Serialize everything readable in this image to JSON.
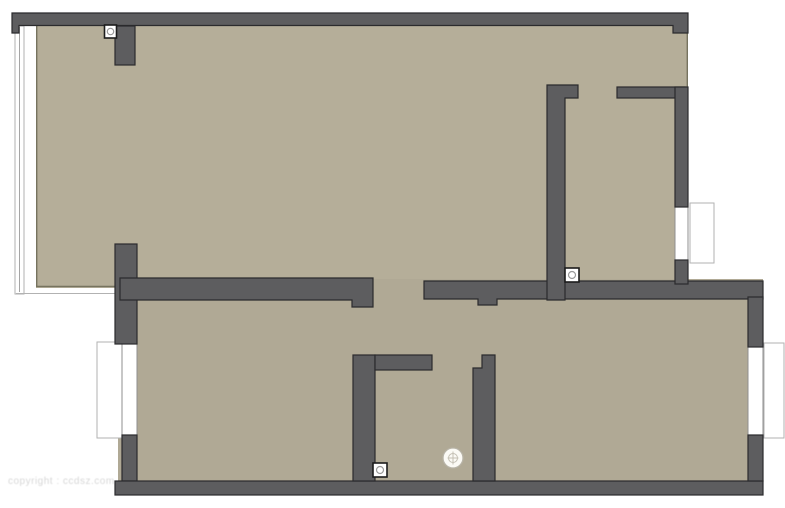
{
  "title": "Apartment Floor Plan",
  "watermark": "copyright : ccdsz.com",
  "colors": {
    "background": "#ffffff",
    "wall": "#5d5d5f",
    "wall_outline": "#2b2b2d",
    "floor": "#b5ae99",
    "floor_lower": "#b0a995",
    "floor_edge": "#76735f",
    "window_fill": "#ffffff",
    "window_frame": "#8f8f8f",
    "frame_light": "#b2b2b2",
    "icon_outline": "#1c1c1c",
    "icon_detail": "#9a9a9a",
    "fixture": "#b7b3a6",
    "watermark": "#d7d7d7"
  },
  "plan": {
    "type": "2D architectural floor plan, unfurnished",
    "areas": [
      {
        "id": "living-area",
        "position": "upper-left, large open space with glass wall on left"
      },
      {
        "id": "bedroom-upper-right",
        "position": "top-right, window on right wall"
      },
      {
        "id": "bedroom-lower-left",
        "position": "bottom-left, window on left wall"
      },
      {
        "id": "bathroom",
        "position": "bottom-center, small room"
      },
      {
        "id": "bedroom-lower-right",
        "position": "bottom-right, window on right wall"
      }
    ],
    "windows": [
      {
        "id": "left-glass-window",
        "side": "left, full height of living area"
      },
      {
        "id": "lower-left-window",
        "side": "left wall of lower-left room"
      },
      {
        "id": "upper-right-window",
        "side": "right wall of upper-right room"
      },
      {
        "id": "lower-right-window",
        "side": "right wall of lower-right room"
      }
    ],
    "icons": [
      {
        "name": "outlet-icon",
        "count": 3,
        "shape": "small white square with circle"
      },
      {
        "name": "light-fixture-icon",
        "count": 1,
        "shape": "small white circle with cross"
      }
    ]
  }
}
